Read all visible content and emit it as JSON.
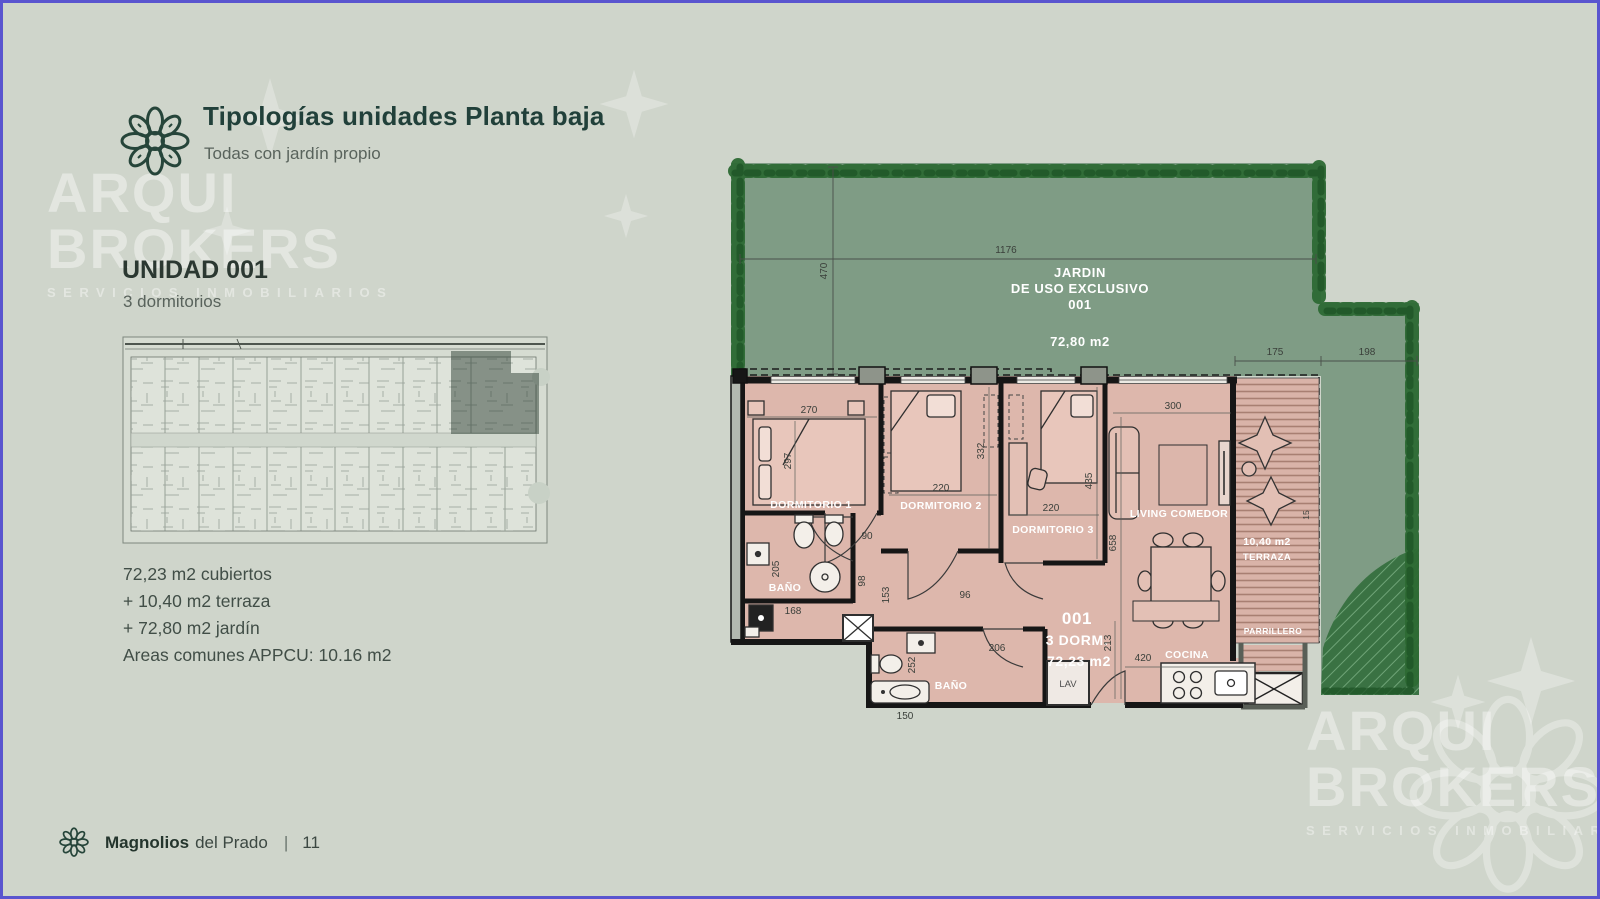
{
  "header": {
    "title": "Tipologías unidades Planta baja",
    "subtitle": "Todas con jardín propio"
  },
  "unit": {
    "name": "UNIDAD 001",
    "subtitle": "3 dormitorios"
  },
  "areas": {
    "line1": "72,23 m2 cubiertos",
    "line2": "+ 10,40 m2 terraza",
    "line3": "+ 72,80 m2 jardín",
    "line4": "Areas comunes APPCU: 10.16 m2"
  },
  "watermark": {
    "line1": "ARQUI",
    "line2": "BROKERS",
    "line3": "SERVICIOS INMOBILIARIOS"
  },
  "footer": {
    "project": "Magnolios",
    "project_suffix": "del Prado",
    "separator": "|",
    "page": "11"
  },
  "plan": {
    "garden": {
      "label1": "JARDIN",
      "label2": "DE USO EXCLUSIVO",
      "label3": "001",
      "area": "72,80 m2"
    },
    "rooms": {
      "dorm1": "DORMITORIO 1",
      "dorm2": "DORMITORIO 2",
      "dorm3": "DORMITORIO 3",
      "living": "LIVING COMEDOR",
      "cocina": "COCINA",
      "bano1": "BAÑO",
      "bano2": "BAÑO",
      "lav": "LAV",
      "terraza_area": "10,40 m2",
      "terraza": "TERRAZA",
      "parrillero": "PARRILLERO"
    },
    "unit_tag": {
      "number": "001",
      "type": "3 DORM.",
      "area": "72,23 m2"
    },
    "dims": {
      "garden_w": "1176",
      "garden_d": "470",
      "terr_w": "175",
      "side_w": "198",
      "d270": "270",
      "d297": "297",
      "d332": "332",
      "d220a": "220",
      "d220b": "220",
      "d435": "435",
      "d300": "300",
      "d658": "658",
      "d90": "90",
      "d98": "98",
      "d153": "153",
      "d96": "96",
      "d205": "205",
      "d168": "168",
      "d252": "252",
      "d150": "150",
      "d206": "206",
      "d213": "213",
      "d420": "420",
      "d15": "15"
    }
  },
  "colors": {
    "frame": "#5a55cf",
    "background": "#cfd5cb",
    "garden_fill": "#7f9c85",
    "foliage": "#2d6a34",
    "floor_pink": "#ddb7ac",
    "wall": "#161616",
    "title_green": "#21403a",
    "highlight": "#2e3f33"
  }
}
